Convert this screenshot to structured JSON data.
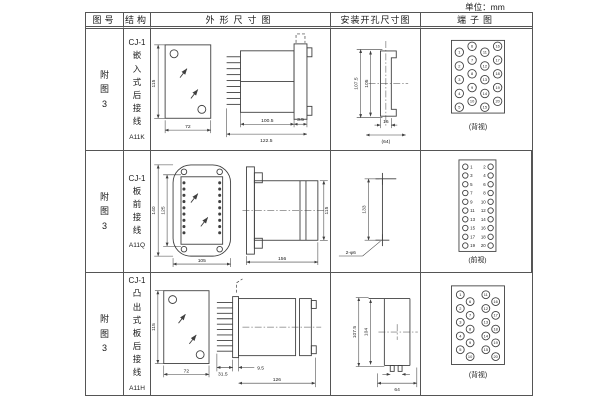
{
  "unit_label": "单位：mm",
  "colors": {
    "line": "#3f3f3f",
    "border": "#555555",
    "text": "#1a1a1a",
    "background": "#ffffff"
  },
  "table": {
    "headers": {
      "fig": "图号",
      "structure": "结构",
      "outline": "外形尺寸图",
      "install": "安装开孔尺寸图",
      "terminal": "端子图"
    },
    "rows": [
      {
        "fig_no": "附图3",
        "structure": {
          "prefix": "CJ-1",
          "name": "嵌入式后接线",
          "code": "A11K"
        },
        "outline_dims": {
          "front_h": "115",
          "front_w": "72",
          "body_len": "100.5",
          "total_len": "122.5",
          "flange_t": "3.5"
        },
        "install_dims": {
          "outer_h": "107.5",
          "inner_h": "105",
          "slot_w": "16",
          "span_w": "(64)"
        },
        "terminal": {
          "view": "(背视)",
          "numbers": [
            "1",
            "2",
            "3",
            "4",
            "5",
            "6",
            "7",
            "8",
            "9",
            "10",
            "11",
            "12",
            "13",
            "14",
            "15",
            "16",
            "17",
            "18",
            "19",
            "20"
          ]
        }
      },
      {
        "fig_no": "附图3",
        "structure": {
          "prefix": "CJ-1",
          "name": "板前接线",
          "code": "A11Q"
        },
        "outline_dims": {
          "outer_h": "140",
          "inner_h": "125",
          "front_w": "105",
          "body_len": "156",
          "side_h": "115"
        },
        "install_dims": {
          "hole_span": "133",
          "hole_label": "2-φ6"
        },
        "terminal": {
          "view": "(前视)",
          "left_numbers": [
            "1",
            "3",
            "5",
            "7",
            "9",
            "11",
            "13",
            "15",
            "17",
            "19"
          ],
          "right_numbers": [
            "2",
            "4",
            "6",
            "8",
            "10",
            "12",
            "14",
            "16",
            "18",
            "20"
          ]
        }
      },
      {
        "fig_no": "附图3",
        "structure": {
          "prefix": "CJ-1",
          "name": "凸出式板后接线",
          "code": "A11H"
        },
        "outline_dims": {
          "front_h": "115",
          "front_w": "72",
          "pin_len": "31.5",
          "step_len": "9.5",
          "body_len": "126"
        },
        "install_dims": {
          "outer_h": "107.5",
          "inner_h": "104",
          "span_w": "64"
        },
        "terminal": {
          "view": "(背视)",
          "numbers": [
            "1",
            "2",
            "3",
            "4",
            "5",
            "6",
            "7",
            "8",
            "9",
            "10",
            "11",
            "12",
            "13",
            "14",
            "15",
            "16",
            "17",
            "18",
            "19",
            "20"
          ]
        }
      }
    ]
  }
}
